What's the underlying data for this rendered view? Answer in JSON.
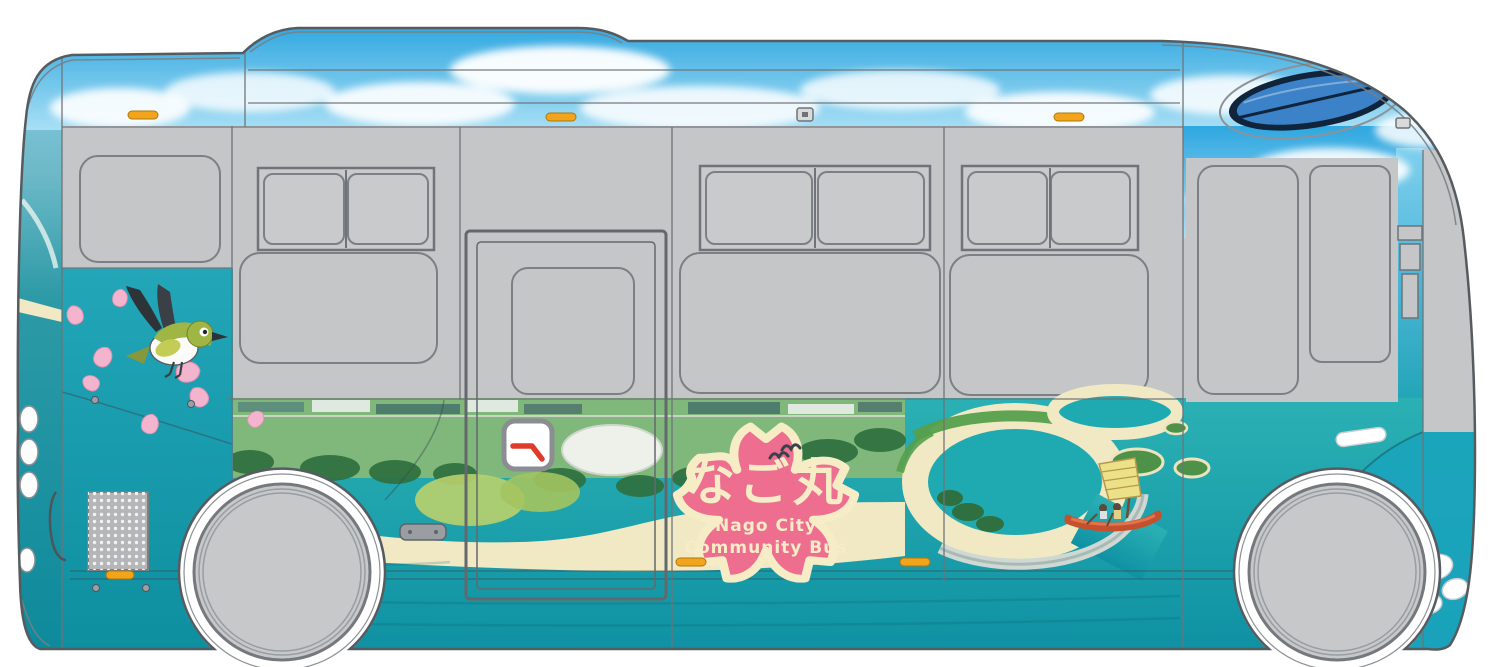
{
  "bus": {
    "logo": {
      "name_ja": "なご丸",
      "name_en_line1": "Nago City",
      "name_en_line2": "Community Bus"
    },
    "colors": {
      "flower_pink": "#ee6e8f",
      "flower_cream": "#f6edc6",
      "petal_pink": "#f3b4cd",
      "sky_top": "#2fa7e0",
      "sky_bottom": "#a8dff5",
      "cloud_white": "#ffffff",
      "body_gray": "#c5c6c8",
      "outline_gray": "#565b60",
      "ocean_top": "#2bb1b4",
      "ocean_bottom": "#0f91a3",
      "lagoon_teal": "#1fa9b0",
      "panel_teal_top": "#22a6b8",
      "panel_teal_bottom": "#0e8fa0",
      "sand": "#f0e9c4",
      "land_green": "#7fb87a",
      "tree_green": "#2f7040",
      "marker_orange": "#f2a51c",
      "bird_green": "#9fb544",
      "bird_dark": "#2e3338",
      "boat_red": "#c4502e",
      "sail_yellow": "#ece089",
      "dome_blue": "#3b82c8",
      "wheel_gray": "#c7c8ca"
    },
    "illustrations": {
      "bird": "white-eye-bird-icon",
      "petals": "sakura-petal-icon",
      "flower": "sakura-flower-logo",
      "boat": "sabani-boat-icon",
      "scene": "nago-beach-aerial-wrap"
    }
  }
}
